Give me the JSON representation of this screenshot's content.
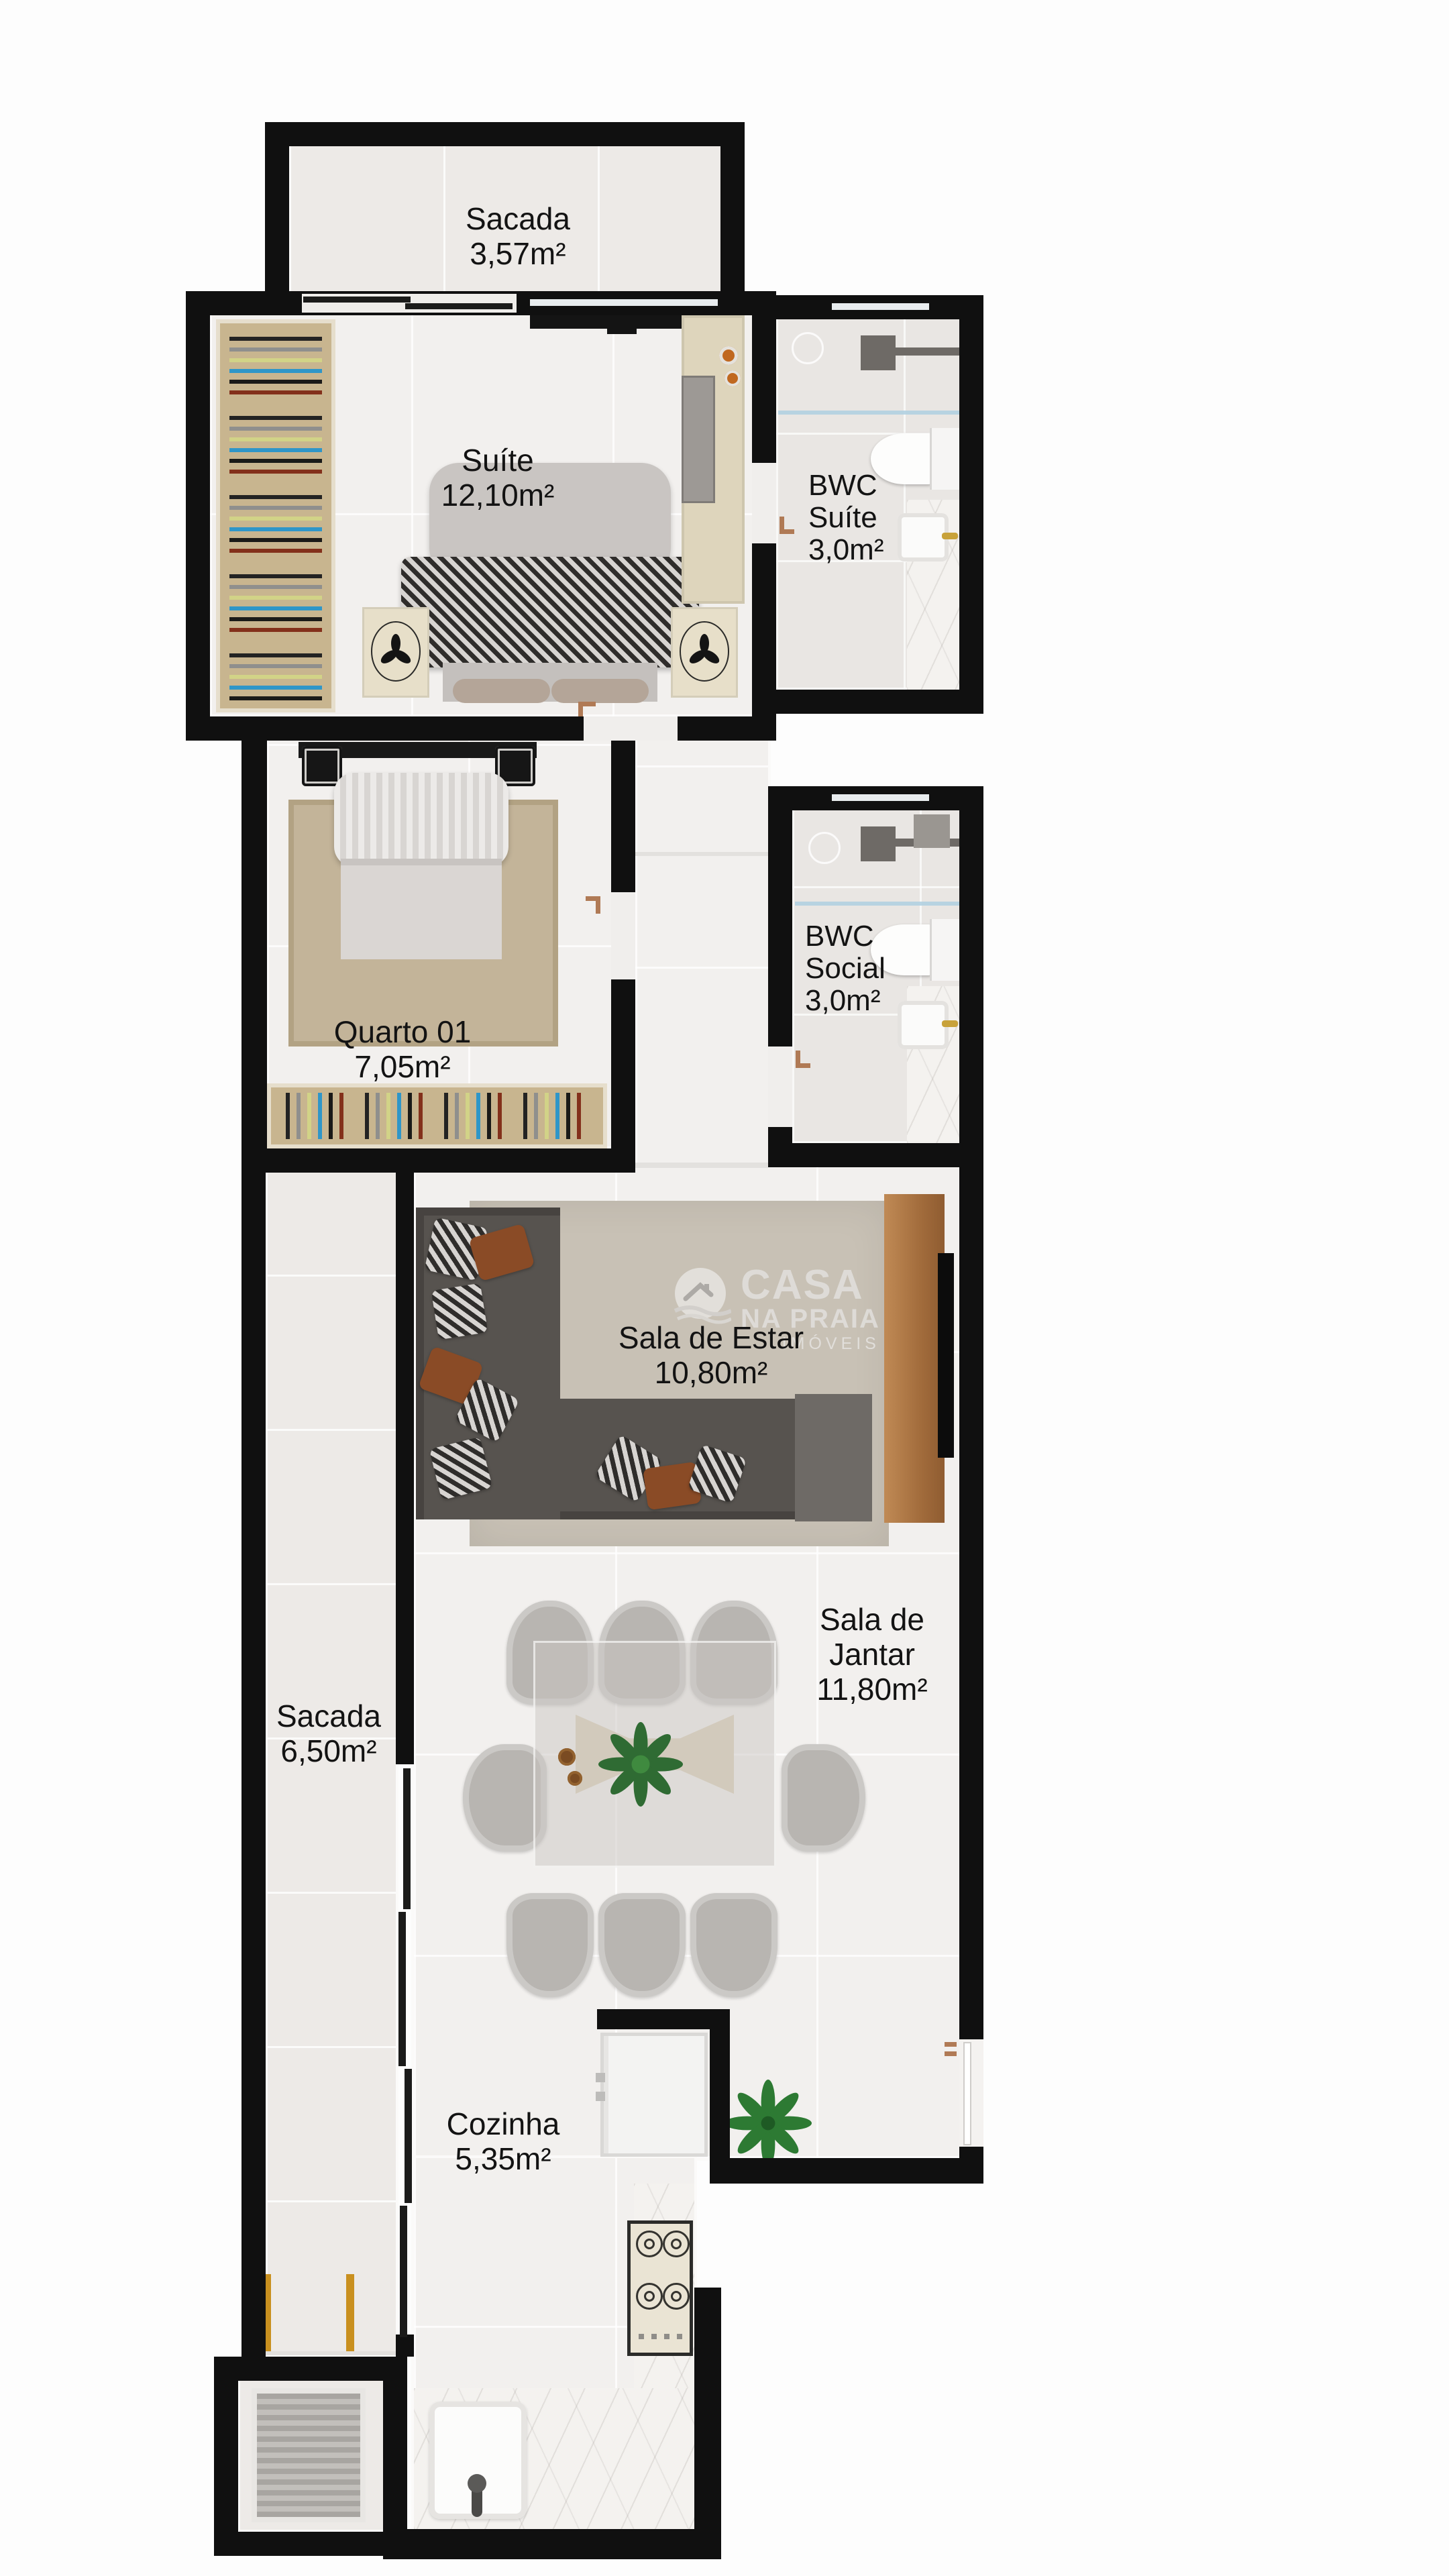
{
  "watermark": {
    "brand_top": "CASA",
    "brand_mid": "NA PRAIA",
    "brand_sub": "IMÓVEIS"
  },
  "rooms": {
    "sacada_top": {
      "name": "Sacada",
      "area": "3,57m²"
    },
    "suite": {
      "name": "Suíte",
      "area": "12,10m²"
    },
    "bwc_suite": {
      "name": "BWC",
      "name2": "Suíte",
      "area": "3,0m²"
    },
    "quarto": {
      "name": "Quarto 01",
      "area": "7,05m²"
    },
    "bwc_social": {
      "name": "BWC",
      "name2": "Social",
      "area": "3,0m²"
    },
    "sala_estar": {
      "name": "Sala de Estar",
      "area": "10,80m²"
    },
    "sala_jantar": {
      "name": "Sala de",
      "name2": "Jantar",
      "area": "11,80m²"
    },
    "sacada_left": {
      "name": "Sacada",
      "area": "6,50m²"
    },
    "cozinha": {
      "name": "Cozinha",
      "area": "5,35m²"
    }
  },
  "colors": {
    "wall": "#101010",
    "label": "#131313",
    "wood": "#b07b4a",
    "closet": "#c8b58f",
    "copper": "#b07a55",
    "watermark": "#e2e0dd"
  }
}
